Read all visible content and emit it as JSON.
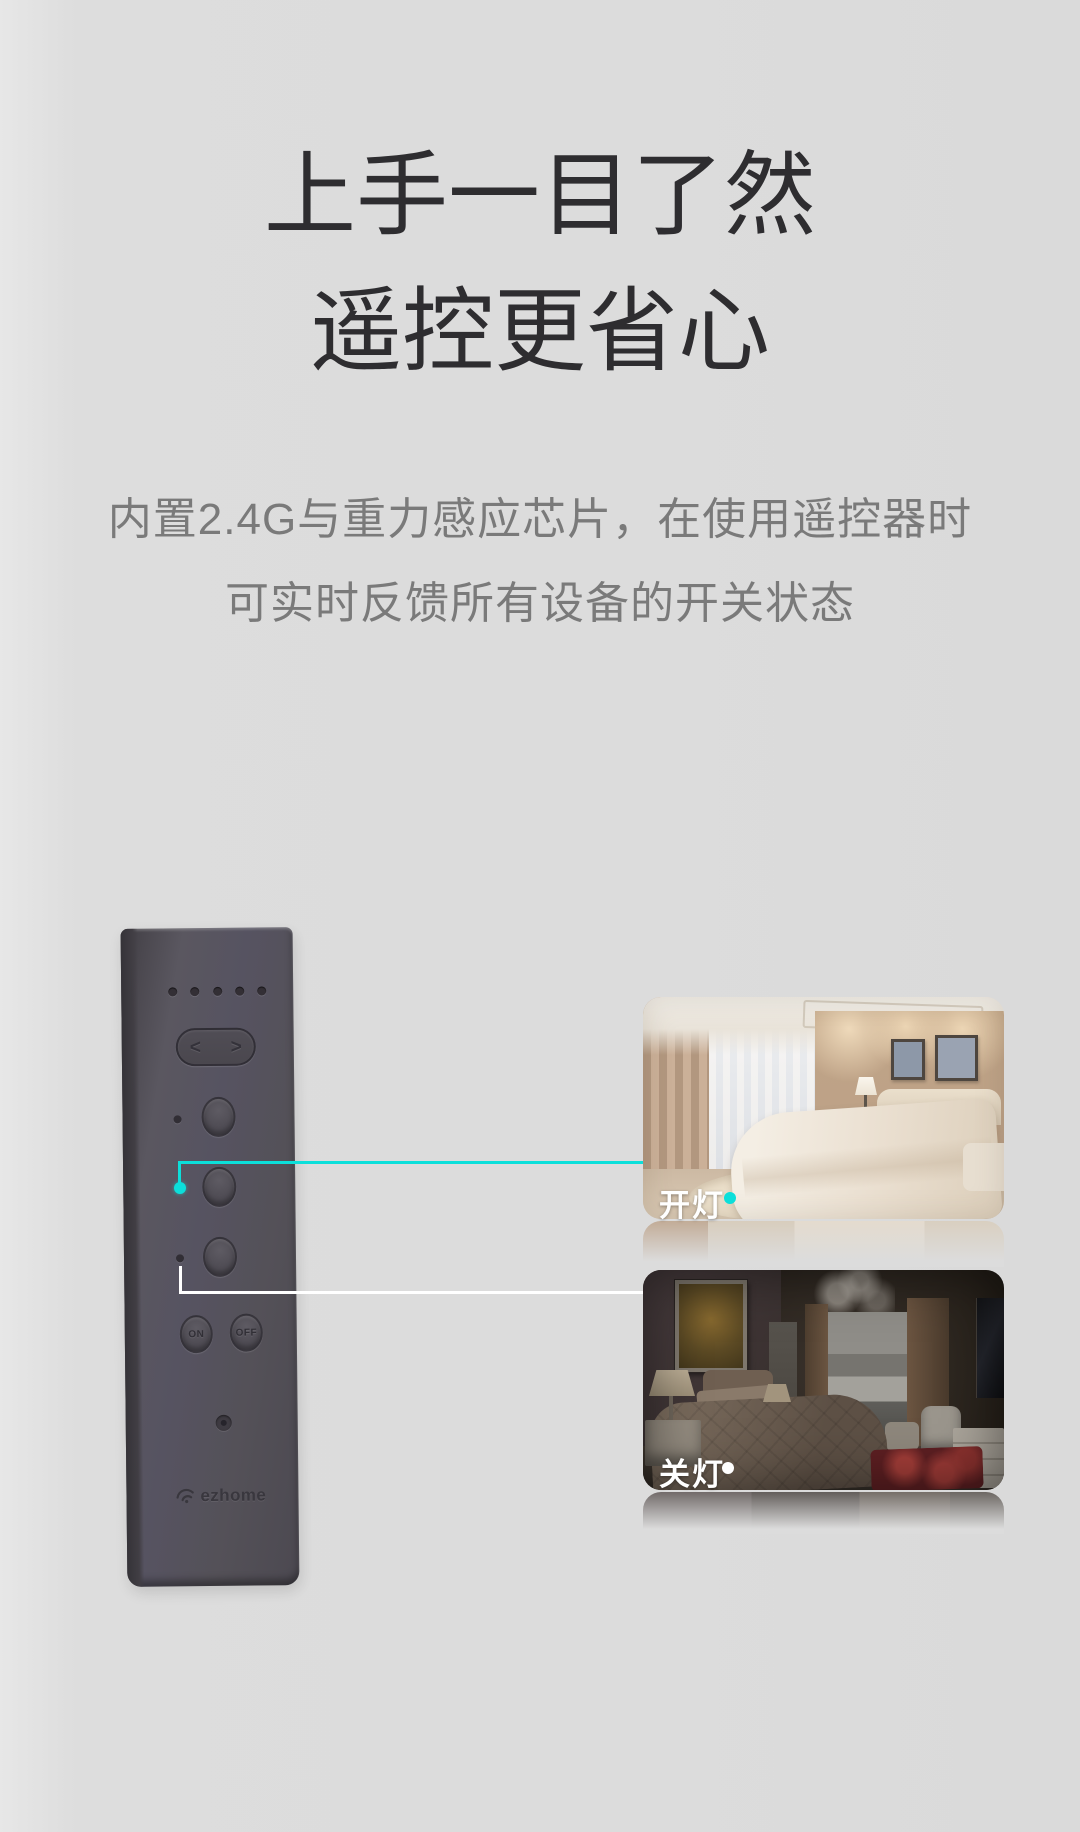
{
  "heading": {
    "line1": "上手一目了然",
    "line2": "遥控更省心"
  },
  "subtitle": {
    "line1": "内置2.4G与重力感应芯片，在使用遥控器时",
    "line2": "可实时反馈所有设备的开关状态"
  },
  "remote": {
    "nav_left": "<",
    "nav_right": ">",
    "on_label": "ON",
    "off_label": "OFF",
    "brand": "ezhome",
    "icons": [
      "chevron-left-icon",
      "chevron-right-icon",
      "signal-icon",
      "pairing-led"
    ]
  },
  "scenes": {
    "on": {
      "label": "开灯",
      "dot_color": "#0cdfda"
    },
    "off": {
      "label": "关灯",
      "dot_color": "#ffffff"
    }
  },
  "colors": {
    "background": "#dcdcdc",
    "title_text": "#2e2d30",
    "subtitle_text": "#7a7a7a",
    "accent_cyan": "#0cdfda",
    "connector_white": "#ffffff",
    "remote_body": "#55525a",
    "label_text": "#ffffff"
  }
}
